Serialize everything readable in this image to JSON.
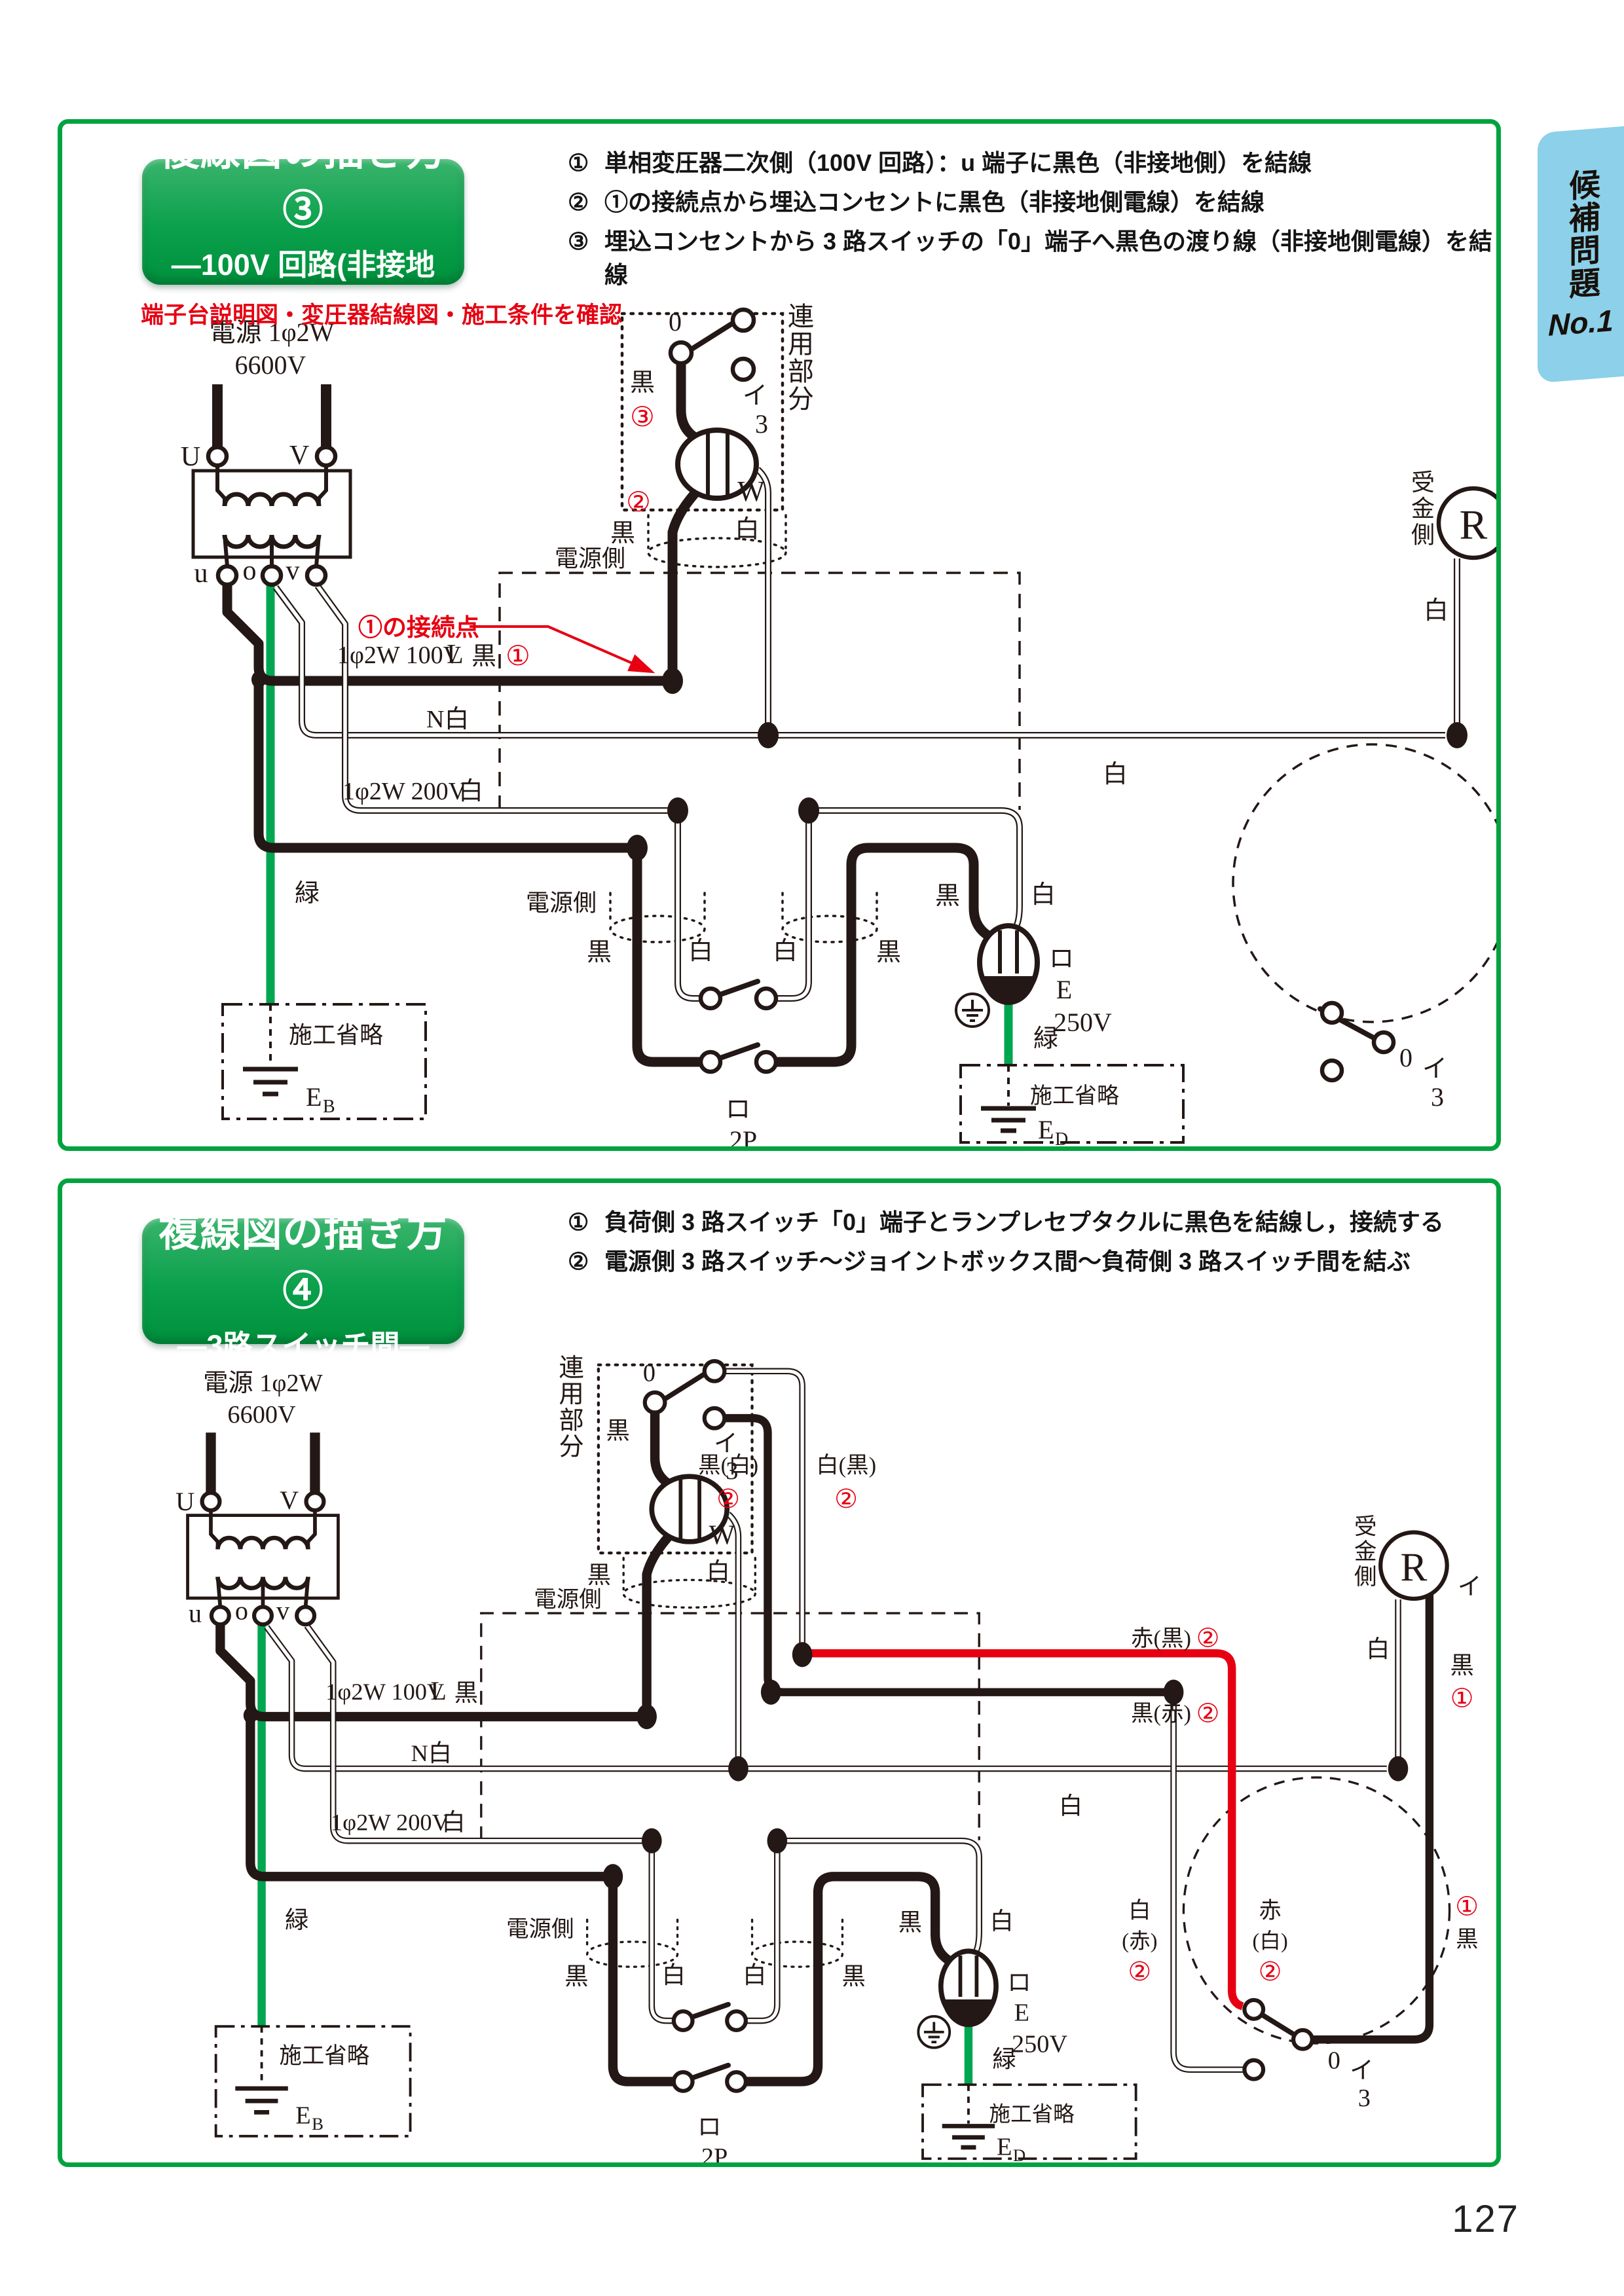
{
  "page": {
    "number": "127"
  },
  "tab": {
    "title": "候補問題",
    "no": "No.1"
  },
  "panel1": {
    "title": "複線図の描き方③",
    "subtitle": "―100V 回路(非接地側)―",
    "note": "端子台説明図・変圧器結線図・施工条件を確認",
    "steps": [
      {
        "n": "①",
        "t": "単相変圧器二次側（100V 回路）：u 端子に黒色（非接地側）を結線"
      },
      {
        "n": "②",
        "t": "①の接続点から埋込コンセントに黒色（非接地側電線）を結線"
      },
      {
        "n": "③",
        "t": "埋込コンセントから 3 路スイッチの「0」端子へ黒色の渡り線（非接地側電線）を結線"
      }
    ]
  },
  "panel2": {
    "title": "複線図の描き方④",
    "subtitle": "―3路スイッチ間―",
    "steps": [
      {
        "n": "①",
        "t": "負荷側 3 路スイッチ「0」端子とランプレセプタクルに黒色を結線し，接続する"
      },
      {
        "n": "②",
        "t": "電源側 3 路スイッチ～ジョイントボックス間～負荷側 3 路スイッチ間を結ぶ"
      }
    ]
  },
  "d": {
    "src1": "電源 1φ2W",
    "src2": "6600V",
    "U": "U",
    "V": "V",
    "u": "u",
    "o": "o",
    "v": "v",
    "renyo": "連用部分",
    "zero": "0",
    "i": "イ",
    "three": "3",
    "W": "W",
    "black": "黒",
    "white": "白",
    "green": "緑",
    "source_side": "電源側",
    "omit": "施工省略",
    "bus100": "1φ2W 100V",
    "L": "L",
    "N": "N白",
    "bus200": "1φ2W 200V",
    "n1": "①",
    "n2": "②",
    "n3": "③",
    "connect_note": "①の接続点",
    "ro": "ロ",
    "twoP": "2P",
    "E": "E",
    "B": "B",
    "D": "D",
    "v250": "250V",
    "ukegane": "受金側",
    "R": "R",
    "t_black": "黒(白)",
    "t_white": "白(黒)",
    "red_h": "赤(黒)",
    "black_h": "黒(赤)",
    "red_v": "赤",
    "red_vp": "(白)",
    "white_v": "白",
    "white_vp": "(赤)"
  }
}
